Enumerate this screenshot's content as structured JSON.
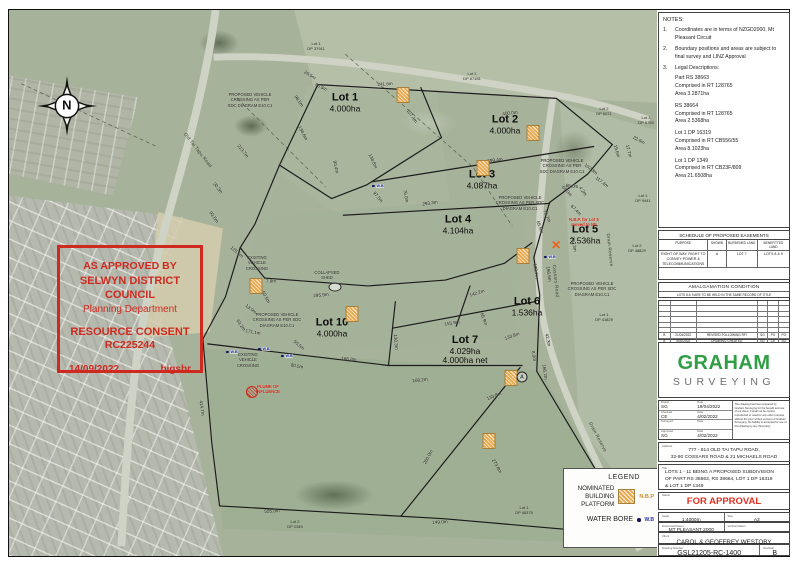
{
  "stamp": {
    "line1": "AS APPROVED BY",
    "line2": "SELWYN DISTRICT COUNCIL",
    "line3": "Planning Department",
    "line4": "RESOURCE CONSENT",
    "line5": "RC225244",
    "date": "14/09/2022",
    "code": "bigsbr",
    "color": "#cf2a20"
  },
  "notes": {
    "title": "NOTES:",
    "items": [
      {
        "num": "1.",
        "text": "Coordinates are in terms of NZGD2000, Mt Pleasant Circuit"
      },
      {
        "num": "2.",
        "text": "Boundary positions and areas are subject to final survey and LINZ Approval"
      },
      {
        "num": "3.",
        "text": "Legal Descriptions:"
      }
    ],
    "legal": [
      [
        "Part RS 38663",
        "Comprised in RT 128765",
        "Area 3.2871ha"
      ],
      [
        "RS 38664",
        "Comprised in RT 128765",
        "Area 2.5368ha"
      ],
      [
        "Lot 1 DP 16319",
        "Comprised in RT CB556/55",
        "Area 8.1023ha"
      ],
      [
        "Lot 1 DP 1349",
        "Comprised in RT CB23F/809",
        "Area 21.6508ha"
      ]
    ]
  },
  "easements": {
    "title": "SCHEDULE OF PROPOSED EASEMENTS",
    "headers": [
      "PURPOSE",
      "SHOWN",
      "BURDENED LAND",
      "BENEFITTED LAND"
    ],
    "rows": [
      [
        "RIGHT OF WAY, RIGHT TO CONVEY POWER & TELECOMMUNICATIONS",
        "A",
        "LOT 7",
        "LOTS 8 & 9"
      ]
    ]
  },
  "amalgamation": {
    "title": "AMALGAMATION CONDITION",
    "text": "LOTS 8 & 9 ARE TO BE HELD IN THE SAME RECORD OF TITLE"
  },
  "revisions": {
    "headers": [
      "Rev",
      "Date",
      "Description",
      "Drwn",
      "Chkd",
      "Appd"
    ],
    "empty_rows": 6,
    "rows": [
      [
        "B",
        "21/04/2022",
        "REVISED FOLLOWING RFI",
        "SG",
        "PO",
        "PO"
      ],
      [
        "A",
        "4/02/2022",
        "DRAWING CREATED",
        "SG",
        "CE",
        "SG"
      ]
    ]
  },
  "logo": {
    "name": "GRAHAM",
    "sub": "SURVEYING",
    "green": "#2f9e44"
  },
  "titleblock": {
    "drawn_label": "Drawn",
    "drawn": "SG",
    "date_label": "Date",
    "drawn_date": "19/04/2022",
    "checked_label": "Checked",
    "checked": "CE",
    "checked_date": "4/02/2022",
    "surveyed_label": "Surveyed",
    "surveyed": "",
    "surveyed_date": "",
    "approved_label": "Approved",
    "approved": "SG",
    "approved_date": "4/02/2022",
    "disclaimer": "This drawing has been prepared by Graham Surveying for the benefit and use of our client. It shall not be copied, reproduced or used for any other purpose without the prior written consent of Graham Surveying. No liability is accepted for use of this drawing by any third party.",
    "address_label": "Address",
    "address1": "777 - 814 OLD TAI TAPU ROAD,",
    "address2": "32-90 COSSARS ROAD & 21 MICHAELS ROAD",
    "title_label": "Title",
    "title1": "LOTS 1 - 11 BEING A PROPOSED SUBDIVISION",
    "title2": "OF PART RS 38663, RS 38664, LOT 1 DP 16319",
    "title3": "& LOT 1 DP 1349",
    "status_label": "Status",
    "status": "FOR APPROVAL",
    "status_note": "NOT TO BE USED FOR CONSTRUCTION PURPOSES",
    "scale_label": "Scale",
    "scale": "1:4000m",
    "size_label": "Size",
    "size": "A3",
    "hdatum_label": "Horizontal Datum",
    "hdatum": "MT PLEASANT 2000",
    "vdatum_label": "Vertical Datum",
    "vdatum": "",
    "client_label": "Client",
    "client": "CAROL & GEOFFREY WESTOBY",
    "dwg_label": "Drawing Number",
    "dwg": "GSL21205-RC-1400",
    "rev_label": "Revision",
    "rev": "B"
  },
  "legend": {
    "title": "LEGEND",
    "nbp_label": "NOMINATED\nBUILDING\nPLATFORM",
    "nbp_abbr": "N.B.P",
    "wb_label": "WATER BORE",
    "wb_abbr": "W.B"
  },
  "map": {
    "compass": "N",
    "wb_text": "W.B",
    "lots": [
      {
        "name": "Lot 1",
        "area": "4.000ha",
        "x": 345,
        "y": 103
      },
      {
        "name": "Lot 2",
        "area": "4.000ha",
        "x": 505,
        "y": 125
      },
      {
        "name": "Lot 3",
        "area": "4.087ha",
        "x": 482,
        "y": 180
      },
      {
        "name": "Lot 4",
        "area": "4.104ha",
        "x": 458,
        "y": 225
      },
      {
        "name": "Lot 5",
        "area": "2.536ha",
        "x": 585,
        "y": 235
      },
      {
        "name": "Lot 6",
        "area": "1.536ha",
        "x": 527,
        "y": 307
      },
      {
        "name": "Lot 7",
        "area": "4.029ha",
        "area2": "4.000ha net",
        "x": 465,
        "y": 350
      },
      {
        "name": "Lot 10",
        "area": "4.000ha",
        "x": 332,
        "y": 328
      }
    ],
    "neighbors": [
      {
        "name": "Lot 1",
        "dp": "DP 37911",
        "x": 316,
        "y": 47
      },
      {
        "name": "Lot 1",
        "dp": "DP 67181",
        "x": 472,
        "y": 77
      },
      {
        "name": "Lot 2",
        "dp": "DP 6071",
        "x": 604,
        "y": 112
      },
      {
        "name": "Lot 3",
        "dp": "DP 5765",
        "x": 646,
        "y": 121
      },
      {
        "name": "Lot 1",
        "dp": "DP 9441",
        "x": 643,
        "y": 199
      },
      {
        "name": "Lot 2",
        "dp": "DP 48829",
        "x": 637,
        "y": 249
      },
      {
        "name": "Lot 1",
        "dp": "DP 41829",
        "x": 604,
        "y": 318
      },
      {
        "name": "Lot 1",
        "dp": "DP 46375",
        "x": 524,
        "y": 511
      },
      {
        "name": "Lot 2",
        "dp": "DP 1349",
        "x": 295,
        "y": 525
      }
    ],
    "roads": [
      {
        "name": "Old Tai Tapu Road",
        "x": 198,
        "y": 150,
        "r": 52
      },
      {
        "name": "Cossars Road",
        "x": 556,
        "y": 281,
        "r": 84
      },
      {
        "name": "Drain Reserve",
        "x": 610,
        "y": 250,
        "r": 84
      },
      {
        "name": "Drain Reserve",
        "x": 598,
        "y": 437,
        "r": 62
      }
    ],
    "measurements": [
      {
        "t": "241.6m",
        "x": 385,
        "y": 84,
        "r": -4
      },
      {
        "t": "400.0m",
        "x": 510,
        "y": 113,
        "r": -6
      },
      {
        "t": "26.5m",
        "x": 310,
        "y": 75,
        "r": 32
      },
      {
        "t": "56.5m",
        "x": 321,
        "y": 87,
        "r": 25
      },
      {
        "t": "98.5m",
        "x": 299,
        "y": 101,
        "r": 55
      },
      {
        "t": "138.6m",
        "x": 303,
        "y": 133,
        "r": 62
      },
      {
        "t": "90.4m",
        "x": 336,
        "y": 167,
        "r": 78
      },
      {
        "t": "138.8m",
        "x": 373,
        "y": 161,
        "r": 65
      },
      {
        "t": "137.4m",
        "x": 412,
        "y": 116,
        "r": 55
      },
      {
        "t": "97.5m",
        "x": 378,
        "y": 197,
        "r": 50
      },
      {
        "t": "76.0m",
        "x": 406,
        "y": 196,
        "r": 80
      },
      {
        "t": "213.7m",
        "x": 243,
        "y": 151,
        "r": 52
      },
      {
        "t": "30.3m",
        "x": 218,
        "y": 188,
        "r": 52
      },
      {
        "t": "93.5m",
        "x": 214,
        "y": 217,
        "r": 55
      },
      {
        "t": "125.5m",
        "x": 237,
        "y": 252,
        "r": 40
      },
      {
        "t": "399.4m",
        "x": 495,
        "y": 160,
        "r": -8
      },
      {
        "t": "293.3m",
        "x": 430,
        "y": 203,
        "r": -8
      },
      {
        "t": "68.0m",
        "x": 567,
        "y": 191,
        "r": 48
      },
      {
        "t": "67.4m",
        "x": 576,
        "y": 210,
        "r": 45
      },
      {
        "t": "79.7m",
        "x": 547,
        "y": 216,
        "r": 65
      },
      {
        "t": "65.5m",
        "x": 540,
        "y": 227,
        "r": 70
      },
      {
        "t": "22.6m",
        "x": 639,
        "y": 140,
        "r": 28
      },
      {
        "t": "19.6m",
        "x": 617,
        "y": 151,
        "r": 75
      },
      {
        "t": "17.7m",
        "x": 629,
        "y": 151,
        "r": 75
      },
      {
        "t": "102.3m",
        "x": 591,
        "y": 169,
        "r": 38
      },
      {
        "t": "117.4m",
        "x": 602,
        "y": 182,
        "r": 38
      },
      {
        "t": "65.0m",
        "x": 572,
        "y": 186,
        "r": 5
      },
      {
        "t": "4.2m",
        "x": 583,
        "y": 191,
        "r": 55
      },
      {
        "t": "360.3m",
        "x": 574,
        "y": 244,
        "r": 80
      },
      {
        "t": "130.7m",
        "x": 536,
        "y": 271,
        "r": 82
      },
      {
        "t": "166.6m",
        "x": 549,
        "y": 274,
        "r": 82
      },
      {
        "t": "42.3m",
        "x": 548,
        "y": 340,
        "r": 78
      },
      {
        "t": "166.2m",
        "x": 545,
        "y": 372,
        "r": 82
      },
      {
        "t": "295.9m",
        "x": 321,
        "y": 295,
        "r": -5
      },
      {
        "t": "142.2m",
        "x": 477,
        "y": 293,
        "r": -18
      },
      {
        "t": "155.9m",
        "x": 452,
        "y": 323,
        "r": -8
      },
      {
        "t": "65.9m",
        "x": 484,
        "y": 319,
        "r": 70
      },
      {
        "t": "133.8m",
        "x": 512,
        "y": 336,
        "r": -20
      },
      {
        "t": "8.0m",
        "x": 534,
        "y": 356,
        "r": 80
      },
      {
        "t": "130.3m",
        "x": 396,
        "y": 342,
        "r": 85
      },
      {
        "t": "50.5m",
        "x": 299,
        "y": 345,
        "r": 40
      },
      {
        "t": "166.8m",
        "x": 349,
        "y": 359,
        "r": 6
      },
      {
        "t": "168.2m",
        "x": 420,
        "y": 380,
        "r": -6
      },
      {
        "t": "133.8m",
        "x": 494,
        "y": 396,
        "r": -22
      },
      {
        "t": "171.1m",
        "x": 253,
        "y": 332,
        "r": 10
      },
      {
        "t": "63.2m",
        "x": 241,
        "y": 325,
        "r": 55
      },
      {
        "t": "13.0m",
        "x": 251,
        "y": 309,
        "r": 38
      },
      {
        "t": "7.9m",
        "x": 271,
        "y": 281,
        "r": 0
      },
      {
        "t": "60.5m",
        "x": 266,
        "y": 297,
        "r": 62
      },
      {
        "t": "80.5m",
        "x": 297,
        "y": 366,
        "r": 10
      },
      {
        "t": "414.7m",
        "x": 202,
        "y": 408,
        "r": 82
      },
      {
        "t": "555.8m",
        "x": 272,
        "y": 511,
        "r": -3
      },
      {
        "t": "149.0m",
        "x": 440,
        "y": 522,
        "r": -3
      },
      {
        "t": "260.0m",
        "x": 428,
        "y": 457,
        "r": -62
      },
      {
        "t": "273.8m",
        "x": 497,
        "y": 466,
        "r": 60
      }
    ],
    "annotations": [
      {
        "t": "PROPOSED VEHICLE\nCROSSING AS PER\nSDC DIAGRAM E10.C1",
        "x": 250,
        "y": 100,
        "red": false
      },
      {
        "t": "PROPOSED VEHICLE\nCROSSING AS PER\nSDC DIAGRAM E10.C1",
        "x": 562,
        "y": 166,
        "red": false
      },
      {
        "t": "PROPOSED VEHICLE\nCROSSING AS PER SDC\nDIAGRAM E10.C1",
        "x": 520,
        "y": 203,
        "red": false
      },
      {
        "t": "PROPOSED VEHICLE\nCROSSING AS PER SDC\nDIAGRAM E10.C1",
        "x": 277,
        "y": 320,
        "red": false
      },
      {
        "t": "PROPOSED VEHICLE\nCROSSING AS PER SDC\nDIAGRAM E10.C1",
        "x": 592,
        "y": 289,
        "red": false
      },
      {
        "t": "EXISTING\nVEHICLE\nCROSSING",
        "x": 257,
        "y": 263,
        "red": false
      },
      {
        "t": "EXISTING\nVEHICLE\nCROSSING",
        "x": 248,
        "y": 360,
        "red": false
      },
      {
        "t": "COLLAPSED\nSHED",
        "x": 327,
        "y": 275,
        "red": false
      },
      {
        "t": "N.B.P. for Lot 5\nmoved to NE",
        "x": 584,
        "y": 222,
        "red": true
      },
      {
        "t": "PLUME OF\nINFLUENCE",
        "x": 268,
        "y": 389,
        "red": true
      }
    ],
    "water_bores": [
      {
        "x": 378,
        "y": 186
      },
      {
        "x": 550,
        "y": 257
      },
      {
        "x": 232,
        "y": 352
      },
      {
        "x": 264,
        "y": 349
      },
      {
        "x": 287,
        "y": 356
      }
    ],
    "building_platforms": [
      {
        "x": 403,
        "y": 95
      },
      {
        "x": 533,
        "y": 133
      },
      {
        "x": 483,
        "y": 168
      },
      {
        "x": 523,
        "y": 256
      },
      {
        "x": 511,
        "y": 378
      },
      {
        "x": 352,
        "y": 314
      },
      {
        "x": 256,
        "y": 286
      },
      {
        "x": 489,
        "y": 441
      }
    ],
    "easement_marker": {
      "label": "A",
      "x": 522,
      "y": 377
    },
    "lot5_cross": {
      "glyph": "×",
      "x": 556,
      "y": 246
    }
  }
}
